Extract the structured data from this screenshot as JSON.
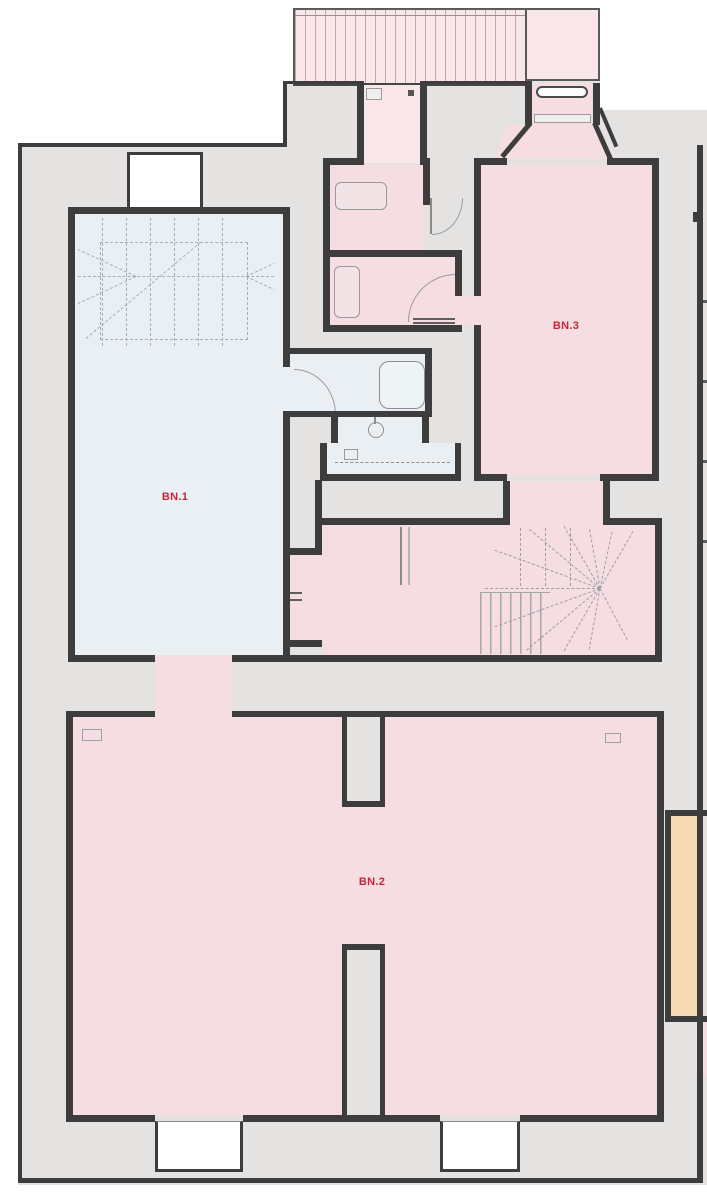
{
  "type": "architectural-floor-plan",
  "rooms": {
    "bn1": {
      "label": "BN.1",
      "fill": "#e9eff2",
      "note": "light blue room with dashed stair outline, upper left"
    },
    "bn2": {
      "label": "BN.2",
      "fill": "#f5dde1",
      "note": "large pink room, bottom"
    },
    "bn3": {
      "label": "BN.3",
      "fill": "#f5dde1",
      "note": "pink room, upper right, entrance with splayed doorway from top"
    }
  },
  "palette": {
    "background": "#ffffff",
    "site_gray": "#e4e3e1",
    "wall": "#3d3d3d",
    "room_pink": "#f5dde1",
    "terrace_pink": "#f8e6e8",
    "room_blue": "#e9eff2",
    "room_orange": "#f6d9b5",
    "label_red": "#c4273b",
    "stair_line": "#a6a6a8"
  }
}
